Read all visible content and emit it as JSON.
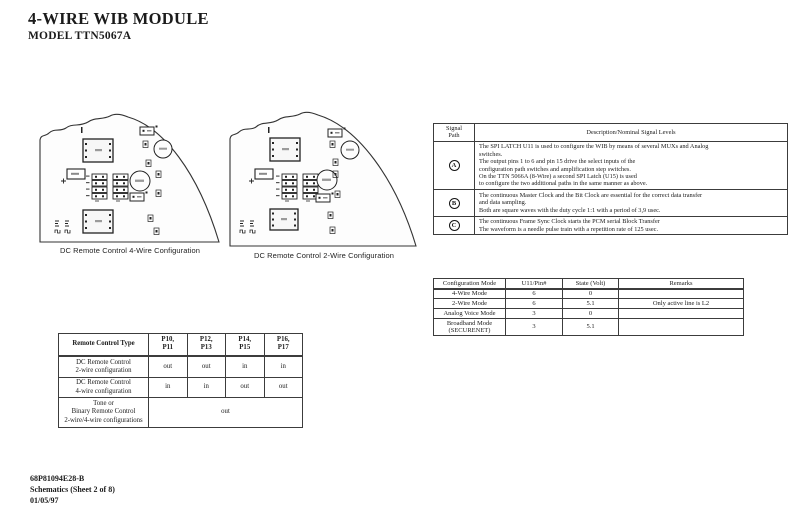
{
  "page": {
    "title": "4-WIRE WIB MODULE",
    "subtitle": "MODEL TTN5067A"
  },
  "diagrams": {
    "left": {
      "caption": "DC Remote Control 4-Wire Configuration"
    },
    "right": {
      "caption": "DC Remote Control 2-Wire Configuration"
    }
  },
  "signal_table": {
    "col1_header": "Signal\nPath",
    "col2_header": "Description/Nominal Signal Levels",
    "rows": [
      {
        "path": "A",
        "description": "The SPI LATCH  U11 is used to configure the WIB by means of several MUXs and Analog\nswitches.\nThe output pins 1 to 6 and pin 15 drive the select inputs of the\nconfiguration path switches and amplification step switches.\nOn the TTN 5066A (8-Wire) a second SPI Latch (U15) is used\nto configure the two additional paths in the same manner as above."
      },
      {
        "path": "B",
        "description": "The continuous Master Clock and the Bit Clock are essential for the correct data transfer\nand data sampling.\nBoth are square waves with the duty cycle 1:1 with a period of 3,9 usec."
      },
      {
        "path": "C",
        "description": "The continuous Frame Sync Clock starts the PCM serial Block Transfer\nThe waveform is a needle pulse train with a repetition rate of 125 usec."
      }
    ]
  },
  "config_table": {
    "headers": [
      "Configuration Mode",
      "U11/Pin#",
      "State (Volt)",
      "Remarks"
    ],
    "rows": [
      {
        "mode": "4-Wire Mode",
        "pin": "6",
        "state": "0",
        "remarks": ""
      },
      {
        "mode": "2-Wire Mode",
        "pin": "6",
        "state": "5.1",
        "remarks": "Only active line is L2"
      },
      {
        "mode": "Analog Voice Mode",
        "pin": "3",
        "state": "0",
        "remarks": ""
      },
      {
        "mode": "Broadband Mode\n(SECURENET)",
        "pin": "3",
        "state": "5.1",
        "remarks": ""
      }
    ]
  },
  "remote_table": {
    "headers": [
      "Remote Control Type",
      "P10,\nP11",
      "P12,\nP13",
      "P14,\nP15",
      "P16,\nP17"
    ],
    "rows": [
      {
        "type": "DC Remote Control\n2-wire configuration",
        "values": [
          "out",
          "out",
          "in",
          "in"
        ]
      },
      {
        "type": "DC Remote Control\n4-wire configuration",
        "values": [
          "in",
          "in",
          "out",
          "out"
        ]
      },
      {
        "type": "Tone or\nBinary Remote Control\n2-wire/4-wire configurations",
        "span_value": "out"
      }
    ]
  },
  "footer": {
    "doc_number": "68P81094E28-B",
    "sheet": "Schematics (Sheet 2 of 8)",
    "date": "01/05/97"
  }
}
